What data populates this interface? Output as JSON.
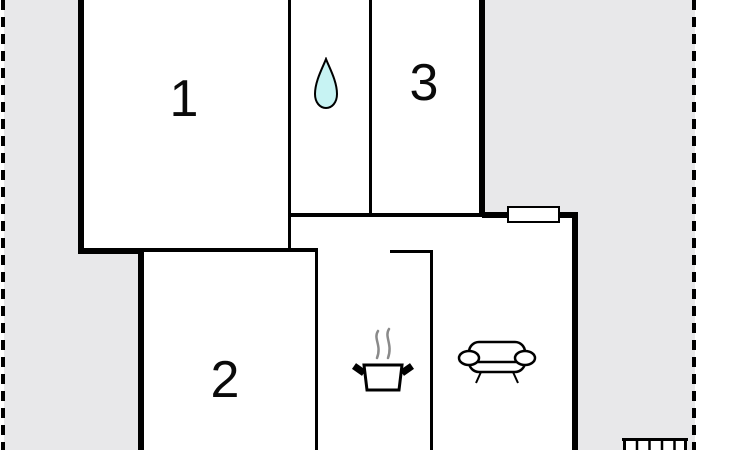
{
  "title": "apartment-floor-plan",
  "colors": {
    "lot": "#e8e8ea",
    "wall": "#000000",
    "water_drop": "#c7f3f3",
    "steam": "#8a8a8a"
  },
  "boundary": {
    "style": "dashed",
    "sides": [
      "left",
      "right"
    ]
  },
  "rooms": [
    {
      "id": "room-1",
      "label": "1"
    },
    {
      "id": "room-2",
      "label": "2"
    },
    {
      "id": "room-3",
      "label": "3"
    },
    {
      "id": "bathroom",
      "label": "",
      "icon": "water-drop-icon"
    },
    {
      "id": "kitchen",
      "label": "",
      "icon": "cooking-pot-icon"
    },
    {
      "id": "living-room",
      "label": "",
      "icon": "sofa-icon"
    }
  ],
  "features": [
    {
      "id": "window",
      "type": "window"
    },
    {
      "id": "stairs",
      "type": "exterior-stairs"
    }
  ]
}
